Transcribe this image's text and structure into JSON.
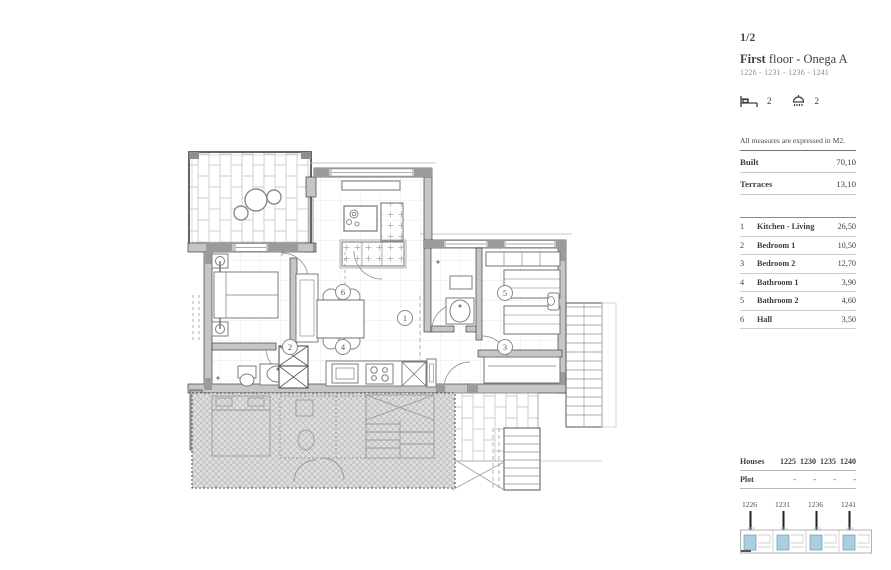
{
  "page": {
    "page_number": "1/2"
  },
  "header": {
    "title_bold": "First",
    "title_rest": " floor - Onega A",
    "units_line": "1226 - 1231 - 1236 - 1241",
    "bedrooms_count": "2",
    "bathrooms_count": "2"
  },
  "measures": {
    "note": "All measures are expressed in M2.",
    "rows": [
      {
        "label": "Built",
        "value": "70,10"
      },
      {
        "label": "Terraces",
        "value": "13,10"
      }
    ]
  },
  "rooms": [
    {
      "n": "1",
      "name": "Kitchen - Living",
      "value": "26,50"
    },
    {
      "n": "2",
      "name": "Bedroom 1",
      "value": "10,50"
    },
    {
      "n": "3",
      "name": "Bedroom 2",
      "value": "12,70"
    },
    {
      "n": "4",
      "name": "Bathroom 1",
      "value": "3,90"
    },
    {
      "n": "5",
      "name": "Bathroom 2",
      "value": "4,60"
    },
    {
      "n": "6",
      "name": "Hall",
      "value": "3,50"
    }
  ],
  "houses_table": {
    "label": "Houses",
    "values": [
      "1225",
      "1230",
      "1235",
      "1240"
    ],
    "plot_label": "Plot",
    "plot_values": [
      "-",
      "-",
      "-",
      "-"
    ]
  },
  "site_plan": {
    "units": [
      "1226",
      "1231",
      "1236",
      "1241"
    ]
  },
  "plan": {
    "labels": [
      "1",
      "2",
      "3",
      "4",
      "5",
      "6"
    ]
  },
  "colors": {
    "highlight_blue": "#a9cfe2",
    "wall_gray": "#c6c6c6",
    "ink": "#3c3c44"
  }
}
